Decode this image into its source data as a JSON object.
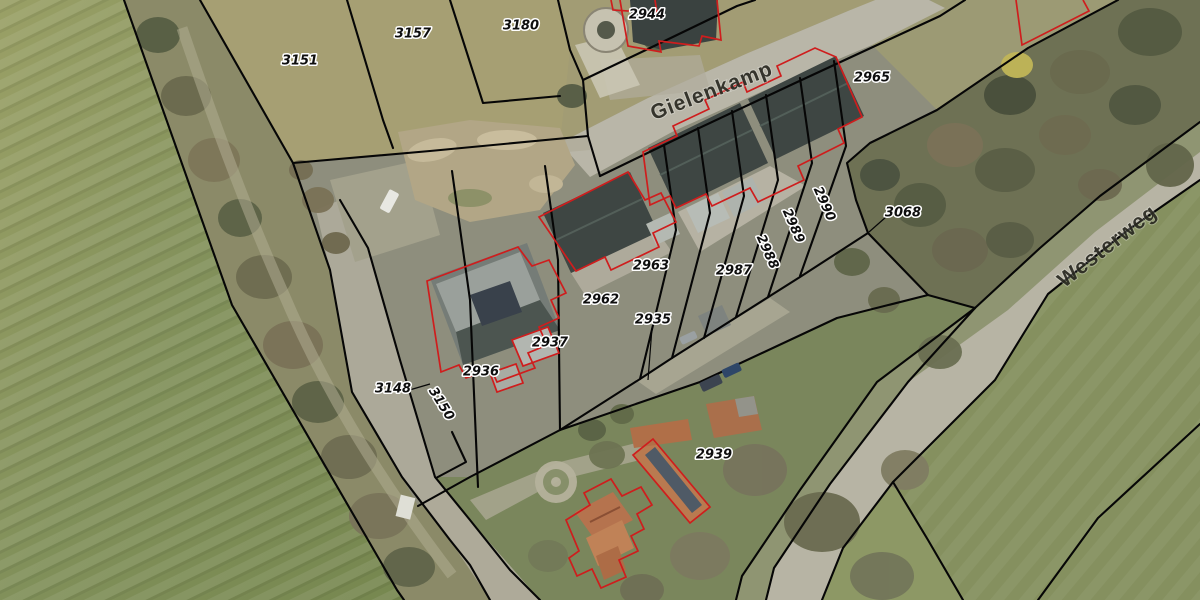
{
  "app": {
    "type": "cadastral-aerial-map"
  },
  "map": {
    "street_labels": [
      {
        "text": "Gielenkamp"
      },
      {
        "text": "Westerweg"
      }
    ],
    "parcel_labels": [
      {
        "text": "3151"
      },
      {
        "text": "3157"
      },
      {
        "text": "3180"
      },
      {
        "text": "2944"
      },
      {
        "text": "2965"
      },
      {
        "text": "3068"
      },
      {
        "text": "2990"
      },
      {
        "text": "2989"
      },
      {
        "text": "2988"
      },
      {
        "text": "2987"
      },
      {
        "text": "2963"
      },
      {
        "text": "2962"
      },
      {
        "text": "2935"
      },
      {
        "text": "2937"
      },
      {
        "text": "2936"
      },
      {
        "text": "3148"
      },
      {
        "text": "3150"
      },
      {
        "text": "2939"
      }
    ],
    "colors": {
      "parcel_boundary": "#060606",
      "building_outline": "#cf1d1d",
      "label_fill": "#0e0e0e",
      "label_halo": "#ffffff",
      "road_surface": "#b9b6a8",
      "field_green": "#7f8c57",
      "woods_green": "#6e7154",
      "roof_dark": "#3e4643",
      "roof_orange": "#b5734e"
    }
  }
}
